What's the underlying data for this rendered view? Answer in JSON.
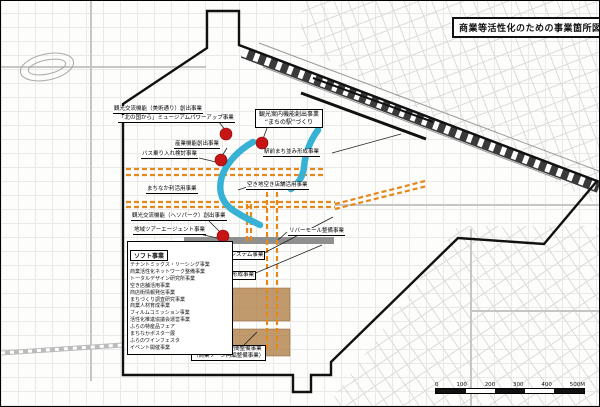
{
  "title": "商業等活性化のための事業箇所図",
  "projects": {
    "museum_line1": "観光交流機能（美術通り）創出事業",
    "museum_line2": "「北の国から」ミュージアムパワーアップ事業",
    "machinoeki_line1": "観光案内機能創出事業",
    "machinoeki_line2": "“まちの駅”づくり",
    "sangyo": "産業機能創出事業",
    "bus": "バス乗り入れ検討事業",
    "machinaka": "まちなか利活用事業",
    "akichi": "空き地空き店舗活用事業",
    "ekimae": "駅前まち並み形成事業",
    "heso": "観光交流機能（ヘソパーク）創出事業",
    "tour": "地域ツアーエージェント事業",
    "rivermall": "リバーモール整備事業",
    "saihoku": "日本最北回数券システム事業",
    "machinami": "まち並み形成事業",
    "gojo_line1": "５条通賑わい空間整備事業",
    "gojo_line2": "（商業ゾーン再編整備事業）"
  },
  "soft_box": {
    "header": "ソフト事業",
    "items": [
      "テナントミックス・リーシング事業",
      "商業活性化ネットワーク整備事業",
      "トータルデザイン研究所事業",
      "空き店舗活用事業",
      "商店街情報発信事業",
      "まちづくり調査研究事業",
      "商業人材育成事業",
      "フィルムコミッション事業",
      "活性化推進協議会運営事業",
      "ふらの特産品フェア",
      "まちなかポスター展",
      "ふらのワインフェスタ",
      "イベント開催事業"
    ]
  },
  "scale_bar": {
    "labels": [
      "0",
      "100",
      "200",
      "300",
      "400",
      "500M"
    ]
  },
  "colors": {
    "marker_red": "#c81414",
    "waterway_blue": "#38b2d4",
    "route_orange": "#e6881c",
    "mall_gray": "#8f8f8f",
    "zone_brown": "#b08048",
    "boundary_black": "#111111"
  }
}
